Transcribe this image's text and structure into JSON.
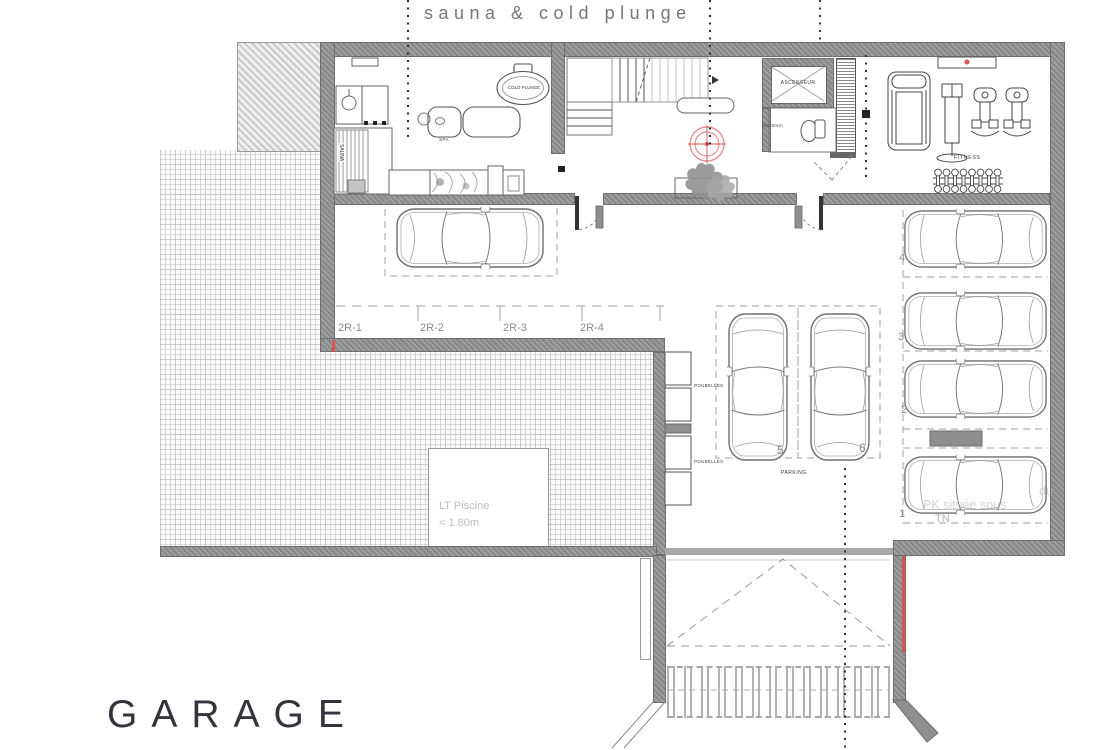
{
  "annotations": {
    "wellness": "sauna & cold plunge",
    "plan_title": "GARAGE",
    "pool_depth_line1": "LT Piscine",
    "pool_depth_line2": "< 1.80m",
    "watermark_line1": "du",
    "watermark_line2": "PK située sous",
    "watermark_line3": "TN"
  },
  "rooms": {
    "sauna": "SAUNA",
    "spa_table": "SPA",
    "cold_plunge": "COLD PLUNGE",
    "fitness": "FITNESS",
    "elevator": "ASCENSEUR",
    "wc_dimension": "80x200cm"
  },
  "parking": {
    "row_labels": [
      "2R-1",
      "2R-2",
      "2R-3",
      "2R-4"
    ],
    "stall_numbers": [
      "1",
      "2",
      "3",
      "4",
      "5",
      "6"
    ],
    "area_label": "PARKING",
    "trash_top": "POUBELLES",
    "trash_bottom": "POUBELLES"
  },
  "colors": {
    "wall": "#8e8e8e",
    "accent_red": "#d9534f",
    "label_gray": "#8c8c8c",
    "faint_gray": "#bcbcbc"
  }
}
